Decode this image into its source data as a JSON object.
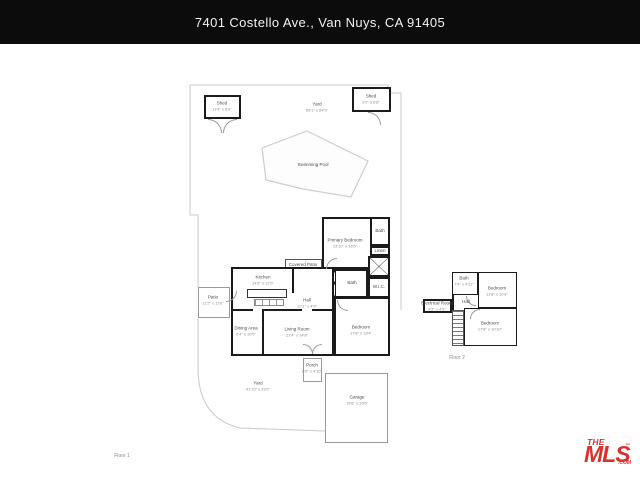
{
  "header": {
    "title": "7401 Costello Ave., Van Nuys, CA 91405"
  },
  "floor1": {
    "label": "Floor 1",
    "yard_top": {
      "name": "Yard",
      "dims": "66'1\" x 54'9\""
    },
    "pool": {
      "name": "Swimming Pool"
    },
    "shed_left": {
      "name": "Shed",
      "dims": "11'4\" x 8'9\""
    },
    "shed_right": {
      "name": "Shed",
      "dims": "9'2\" x 6'8\""
    },
    "covered_patio": {
      "name": "Covered Patio",
      "dims": "13'9\" x 4'0\""
    },
    "kitchen": {
      "name": "Kitchen",
      "dims": "14'6\" x 12'6\""
    },
    "hall": {
      "name": "Hall",
      "dims": "12'1\" x 4'9\""
    },
    "patio": {
      "name": "Patio",
      "dims": "11'2\" x 11'6\""
    },
    "dining": {
      "name": "Dining Area",
      "dims": "9'4\" x 10'5\""
    },
    "living": {
      "name": "Living Room",
      "dims": "21'4\" x 14'8\""
    },
    "primary": {
      "name": "Primary Bedroom",
      "dims": "13'10\" x 16'5\""
    },
    "bath_primary": {
      "name": "Bath",
      "dims": "8'0\" x 4'11\""
    },
    "linen": {
      "name": "Linen"
    },
    "bath_hall": {
      "name": "Bath",
      "dims": "8'2\" x 7'0\""
    },
    "wic": {
      "name": "W.I.C.",
      "dims": "6'11\" x 6'6\""
    },
    "bedroom": {
      "name": "Bedroom",
      "dims": "17'8\" x 13'4\""
    },
    "porch": {
      "name": "Porch",
      "dims": "6'6\" x 4'10\""
    },
    "garage": {
      "name": "Garage",
      "dims": "19'6\" x 19'6\""
    },
    "yard_bottom": {
      "name": "Yard",
      "dims": "41'10\" x 29'2\""
    }
  },
  "floor2": {
    "label": "Floor 2",
    "bath": {
      "name": "Bath",
      "dims": "7'4\" x 4'11\""
    },
    "bedroom_top": {
      "name": "Bedroom",
      "dims": "11'8\" x 10'9\""
    },
    "electrical": {
      "name": "Electrical Room",
      "dims": "9'2\" x 4'5\""
    },
    "hall": {
      "name": "Hall",
      "dims": "6'1\" x 3'10\""
    },
    "bedroom_bottom": {
      "name": "Bedroom",
      "dims": "17'8\" x 10'10\""
    }
  },
  "logo": {
    "the": "THE",
    "mls": "MLS",
    "tm": "™",
    "com": ".COM",
    "red": "#d7332d"
  }
}
